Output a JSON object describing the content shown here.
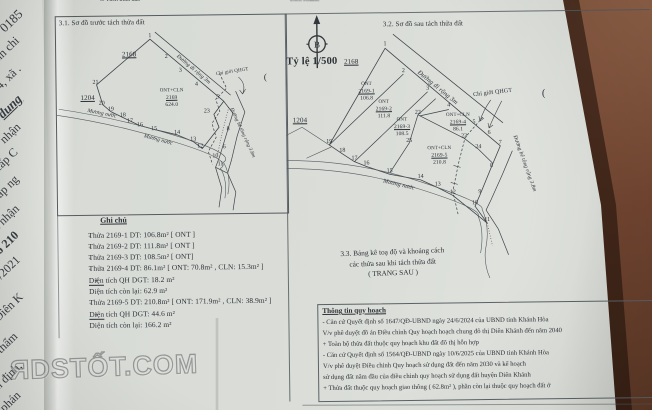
{
  "photo": {
    "table_color": "#50301f",
    "paper_color": "#d9dcd7",
    "ink_color": "#2e3237"
  },
  "top_fragments": {
    "left": "3. Tách thửa đất.",
    "right": "Diên Khánh"
  },
  "underpage": {
    "fragments": [
      {
        "t": "0185",
        "x": 2,
        "y": 22,
        "s": 13
      },
      {
        "t": "nh chi",
        "x": -4,
        "y": 52,
        "s": 12
      },
      {
        "t": "4, xã .",
        "x": -2,
        "y": 80,
        "s": 12
      },
      {
        "t": "dung",
        "x": 0,
        "y": 108,
        "s": 13,
        "c": "b i u"
      },
      {
        "t": "nhận",
        "x": 2,
        "y": 134,
        "s": 12
      },
      {
        "t": "cấp C",
        "x": -4,
        "y": 162,
        "s": 12
      },
      {
        "t": "cấp ng",
        "x": -6,
        "y": 192,
        "s": 12
      },
      {
        "t": "i nhận",
        "x": -4,
        "y": 220,
        "s": 12
      },
      {
        "t": "số 210",
        "x": -6,
        "y": 248,
        "s": 12,
        "c": "b"
      },
      {
        "t": "05/2021",
        "x": -10,
        "y": 278,
        "s": 12
      },
      {
        "t": "Diên K",
        "x": -4,
        "y": 312,
        "s": 12
      },
      {
        "t": "ó thẩm",
        "x": -8,
        "y": 350,
        "s": 12
      },
      {
        "t": "ẩm định,",
        "x": -10,
        "y": 386,
        "s": 12
      },
      {
        "t": "a phán",
        "x": -4,
        "y": 408,
        "s": 12
      }
    ]
  },
  "compass": {
    "label": "B"
  },
  "scale_label": "Tỷ lệ 1/500",
  "sections": {
    "s31": {
      "title": "3.1. Sơ đồ trước tách thửa đất"
    },
    "s32": {
      "title": "3.2. Sơ đồ sau tách thửa đất"
    },
    "s33": {
      "lines": [
        "3.3. Bảng kê toạ độ và khoảng cách",
        "các thửa sau khi tách thửa đất",
        "( TRANG SAU )"
      ]
    },
    "notes": {
      "title": "Ghi chú",
      "items": [
        {
          "bullet": "-",
          "text": "Thửa 2169-1 DT:  106.8m²  [ ONT ]"
        },
        {
          "bullet": "-",
          "text": "Thửa 2169-2 DT:  111.8m²  [ ONT ]"
        },
        {
          "bullet": "-",
          "text": "Thửa 2169-3 DT:  108.5m²  [ ONT]"
        },
        {
          "bullet": "-",
          "text": "Thửa 2169-4 DT:  86.1m²  [ ONT: 70.8m² , CLN: 15.3m² ]"
        },
        {
          "bullet": "+",
          "text": "Diện tích QH DGT:   18.2 m²"
        },
        {
          "bullet": "",
          "text": "Diện tích còn lại: 62.9 m²"
        },
        {
          "bullet": "-",
          "text": "Thửa 2169-5 DT:  210.8m²  [ ONT: 171.9m² , CLN: 38.9m² ]"
        },
        {
          "bullet": "+",
          "text": "Diện tích QH DGT:   44.6 m²"
        },
        {
          "bullet": "",
          "text": "Diện tích còn lại: 166.2 m²"
        }
      ]
    },
    "planning": {
      "title": "Thông tin quy hoạch",
      "lines": [
        "- Căn cứ Quyết định số 1647/QĐ-UBND ngày 24/6/2024  của UBND tỉnh Khánh Hòa",
        "V/v phê duyệt đồ án Điều chỉnh Quy hoạch hoạch chung đô thị Diên Khánh đến năm 2040",
        "+ Toàn bộ thửa đất thuộc quy hoạch khu đất đô thị hỗn hợp",
        "- Căn cứ Quyết định số 1564/QĐ-UBND ngày 10/6/2025 của UBND tỉnh Khánh Hòa",
        "V/v phê duyệt Điều chỉnh Quy hoạch sử dụng đất đến năm 2030 và kế hoạch",
        "sử dụng đất năm đầu của điều chỉnh quy hoạch sử dụng đất huyện Diên Khánh",
        "+ Thửa đất thuộc quy hoạch giao thông ( 62.8m² ), phần còn lại thuộc quy hoạch đất ở"
      ]
    }
  },
  "diagram31": {
    "labels": [
      {
        "t": "2168",
        "x": 74,
        "y": 38,
        "s": 7,
        "c": "u"
      },
      {
        "t": "1204",
        "x": 32,
        "y": 81,
        "s": 7,
        "c": "u"
      },
      {
        "t": "ONT+CLN",
        "x": 116,
        "y": 75,
        "s": 5
      },
      {
        "t": "2169",
        "x": 116,
        "y": 82,
        "s": 5.5,
        "c": "u"
      },
      {
        "t": "624.0",
        "x": 116,
        "y": 89,
        "s": 5.5
      },
      {
        "t": "Đường đi rộng 3m",
        "x": 138,
        "y": 54,
        "s": 5.5,
        "r": 41,
        "c": "i"
      },
      {
        "t": "Chỉ giới QHGT",
        "x": 177,
        "y": 57,
        "s": 5,
        "r": -8
      },
      {
        "t": "Mương nước",
        "x": 46,
        "y": 97,
        "s": 5.5,
        "r": 12,
        "c": "i"
      },
      {
        "t": "Mương nước",
        "x": 102,
        "y": 124,
        "s": 5.5,
        "r": 16,
        "c": "i"
      },
      {
        "t": "Đường bê tông rộng 3.8m",
        "x": 186,
        "y": 118,
        "s": 5,
        "r": 66,
        "c": "i"
      },
      {
        "t": "(",
        "x": 210,
        "y": 62,
        "s": 9
      }
    ],
    "vertices": [
      {
        "n": "1",
        "x": 95,
        "y": 20
      },
      {
        "n": "2",
        "x": 111,
        "y": 41
      },
      {
        "n": "3",
        "x": 125,
        "y": 55
      },
      {
        "n": "4",
        "x": 141,
        "y": 69
      },
      {
        "n": "5",
        "x": 162,
        "y": 82
      },
      {
        "n": "21",
        "x": 40,
        "y": 66
      },
      {
        "n": "20",
        "x": 46,
        "y": 87
      },
      {
        "n": "19",
        "x": 55,
        "y": 93
      },
      {
        "n": "18",
        "x": 67,
        "y": 99
      },
      {
        "n": "17",
        "x": 74,
        "y": 105
      },
      {
        "n": "16",
        "x": 84,
        "y": 109
      },
      {
        "n": "15",
        "x": 98,
        "y": 113
      },
      {
        "n": "14",
        "x": 121,
        "y": 117
      },
      {
        "n": "13",
        "x": 137,
        "y": 124
      },
      {
        "n": "12",
        "x": 144,
        "y": 131
      },
      {
        "n": "23",
        "x": 151,
        "y": 96
      },
      {
        "n": "8",
        "x": 172,
        "y": 114
      },
      {
        "n": "6",
        "x": 168,
        "y": 132
      },
      {
        "n": "10",
        "x": 159,
        "y": 141
      },
      {
        "n": "11",
        "x": 164,
        "y": 149
      }
    ]
  },
  "diagram32": {
    "labels": [
      {
        "t": "2168",
        "x": 66,
        "y": 48,
        "s": 7,
        "c": "u"
      },
      {
        "t": "1204",
        "x": 14,
        "y": 106,
        "s": 7,
        "c": "u"
      },
      {
        "t": "ONT",
        "x": 81,
        "y": 71,
        "s": 5
      },
      {
        "t": "2169-1",
        "x": 81,
        "y": 78,
        "s": 5.5,
        "c": "u"
      },
      {
        "t": "106.8",
        "x": 81,
        "y": 85,
        "s": 5.5
      },
      {
        "t": "ONT",
        "x": 98,
        "y": 89,
        "s": 5
      },
      {
        "t": "2169-2",
        "x": 98,
        "y": 96,
        "s": 5.5,
        "c": "u"
      },
      {
        "t": "111.8",
        "x": 98,
        "y": 103,
        "s": 5.5
      },
      {
        "t": "ONT",
        "x": 116,
        "y": 107,
        "s": 5
      },
      {
        "t": "2169-3",
        "x": 116,
        "y": 114,
        "s": 5.5,
        "c": "u"
      },
      {
        "t": "108.5",
        "x": 116,
        "y": 121,
        "s": 5.5
      },
      {
        "t": "ONT+CLN",
        "x": 172,
        "y": 103,
        "s": 5
      },
      {
        "t": "2169-4",
        "x": 172,
        "y": 110,
        "s": 5.5,
        "c": "u"
      },
      {
        "t": "86.1",
        "x": 172,
        "y": 117,
        "s": 5.5
      },
      {
        "t": "ONT+CLN",
        "x": 153,
        "y": 136,
        "s": 5
      },
      {
        "t": "2169-5",
        "x": 153,
        "y": 143,
        "s": 5.5,
        "c": "u"
      },
      {
        "t": "210.8",
        "x": 153,
        "y": 150,
        "s": 5.5
      },
      {
        "t": "Đường đi rộng 3m",
        "x": 152,
        "y": 75,
        "s": 6.5,
        "r": 40,
        "c": "i"
      },
      {
        "t": "Chỉ giới QHGT",
        "x": 207,
        "y": 81,
        "s": 6,
        "r": -6
      },
      {
        "t": "Đường bê tông rộng 3.8m",
        "x": 238,
        "y": 152,
        "s": 5.5,
        "r": 71,
        "c": "i"
      },
      {
        "t": "Mương nước",
        "x": 112,
        "y": 172,
        "s": 6,
        "r": 14,
        "c": "i"
      },
      {
        "t": "(",
        "x": 258,
        "y": 82,
        "s": 10
      }
    ],
    "vertices": [
      {
        "n": "1",
        "x": 100,
        "y": 31
      },
      {
        "n": "2",
        "x": 118,
        "y": 58
      },
      {
        "n": "3",
        "x": 142,
        "y": 76
      },
      {
        "n": "4",
        "x": 163,
        "y": 93
      },
      {
        "n": "5",
        "x": 188,
        "y": 110
      },
      {
        "n": "6",
        "x": 203,
        "y": 121
      },
      {
        "n": "7",
        "x": 214,
        "y": 131
      },
      {
        "n": "8",
        "x": 205,
        "y": 154
      },
      {
        "n": "9",
        "x": 193,
        "y": 180
      },
      {
        "n": "10",
        "x": 188,
        "y": 191
      },
      {
        "n": "11",
        "x": 200,
        "y": 208
      },
      {
        "n": "12",
        "x": 166,
        "y": 180
      },
      {
        "n": "13",
        "x": 151,
        "y": 172
      },
      {
        "n": "14",
        "x": 134,
        "y": 164
      },
      {
        "n": "15",
        "x": 103,
        "y": 158
      },
      {
        "n": "16",
        "x": 80,
        "y": 150
      },
      {
        "n": "17",
        "x": 68,
        "y": 145
      },
      {
        "n": "18",
        "x": 56,
        "y": 137
      },
      {
        "n": "19",
        "x": 43,
        "y": 128
      },
      {
        "n": "22",
        "x": 132,
        "y": 100
      },
      {
        "n": "23",
        "x": 178,
        "y": 124
      },
      {
        "n": "24",
        "x": 192,
        "y": 135
      },
      {
        "n": "25",
        "x": 123,
        "y": 128
      }
    ]
  },
  "watermark": "ЯDSTỐT.COM"
}
